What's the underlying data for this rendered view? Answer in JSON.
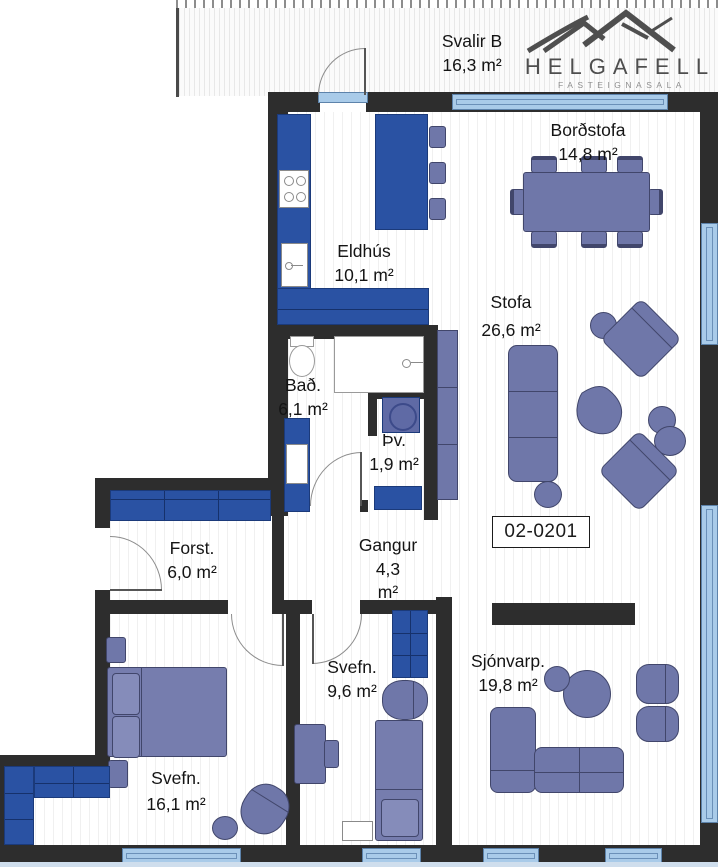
{
  "logo": {
    "brand": "HELGAFELL",
    "tagline": "FASTEIGNASALA",
    "icon": "mountains-icon"
  },
  "unit": {
    "label": "02-0201"
  },
  "rooms": [
    {
      "key": "svalir",
      "name": "Svalir B",
      "area": "16,3 m²"
    },
    {
      "key": "bordstofa",
      "name": "Borðstofa",
      "area": "14,8 m²"
    },
    {
      "key": "eldhus",
      "name": "Eldhús",
      "area": "10,1 m²"
    },
    {
      "key": "stofa",
      "name": "Stofa",
      "area": "26,6 m²"
    },
    {
      "key": "bad",
      "name": "Bað.",
      "area": "6,1 m²"
    },
    {
      "key": "thvottahus",
      "name": "Þv.",
      "area": "1,9 m²"
    },
    {
      "key": "forstofa",
      "name": "Forst.",
      "area": "6,0 m²"
    },
    {
      "key": "gangur",
      "name": "Gangur",
      "area": "4,3",
      "unit": "m²"
    },
    {
      "key": "svefn-9",
      "name": "Svefn.",
      "area": "9,6 m²"
    },
    {
      "key": "svefn-16",
      "name": "Svefn.",
      "area": "16,1 m²"
    },
    {
      "key": "sjonvarp",
      "name": "Sjónvarp.",
      "area": "19,8 m²"
    }
  ],
  "colors": {
    "wall": "#2d2d2d",
    "cabinet_blue": "#2a52a3",
    "furniture_slate": "#6f77a9",
    "window_blue": "#a9cbe9",
    "window_frame": "#5d83ab",
    "text": "#141414",
    "logo_gray": "#4e4e4e"
  }
}
